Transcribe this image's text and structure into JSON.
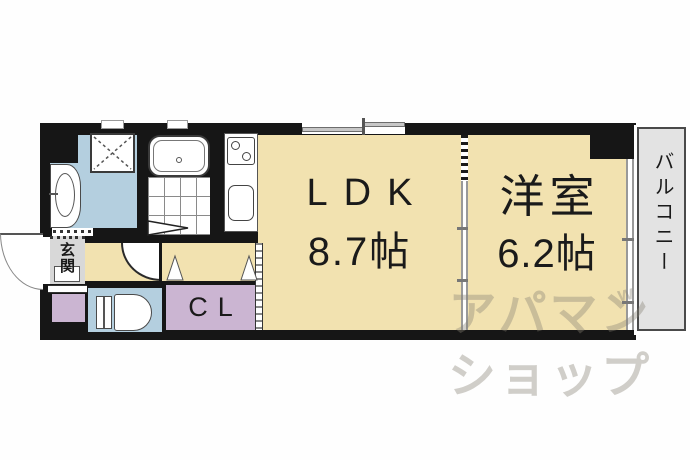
{
  "plan_type": "apartment-floorplan",
  "rooms": {
    "ldk": {
      "label": "LDK",
      "size": "8.7帖"
    },
    "western": {
      "label": "洋室",
      "size": "6.2帖"
    },
    "balcony": {
      "label": "バルコニー"
    },
    "entrance": {
      "label": "玄関"
    },
    "closet": {
      "label": "CL"
    }
  },
  "fixtures": [
    "bathtub",
    "bathroom-tile-floor",
    "bathroom-folding-door",
    "washing-machine-pan",
    "vanity-basin",
    "toilet",
    "gas-stove-two-burner",
    "kitchen-sink",
    "entry-door-swing",
    "hall-door-swing",
    "closet-door-triangles",
    "sliding-window-top",
    "sliding-door-ldk-western",
    "window-to-balcony"
  ],
  "watermark": {
    "line1": "アパマン",
    "accent": "w",
    "line2": "ショップ"
  },
  "colors": {
    "wall": "#161616",
    "cream": "#f2e2b0",
    "blue": "#b4cfdf",
    "purple": "#cbb5d2",
    "entry": "#d8d8d8",
    "balcony": "#e3e3e3",
    "watermark": "rgba(135,128,115,0.38)"
  }
}
